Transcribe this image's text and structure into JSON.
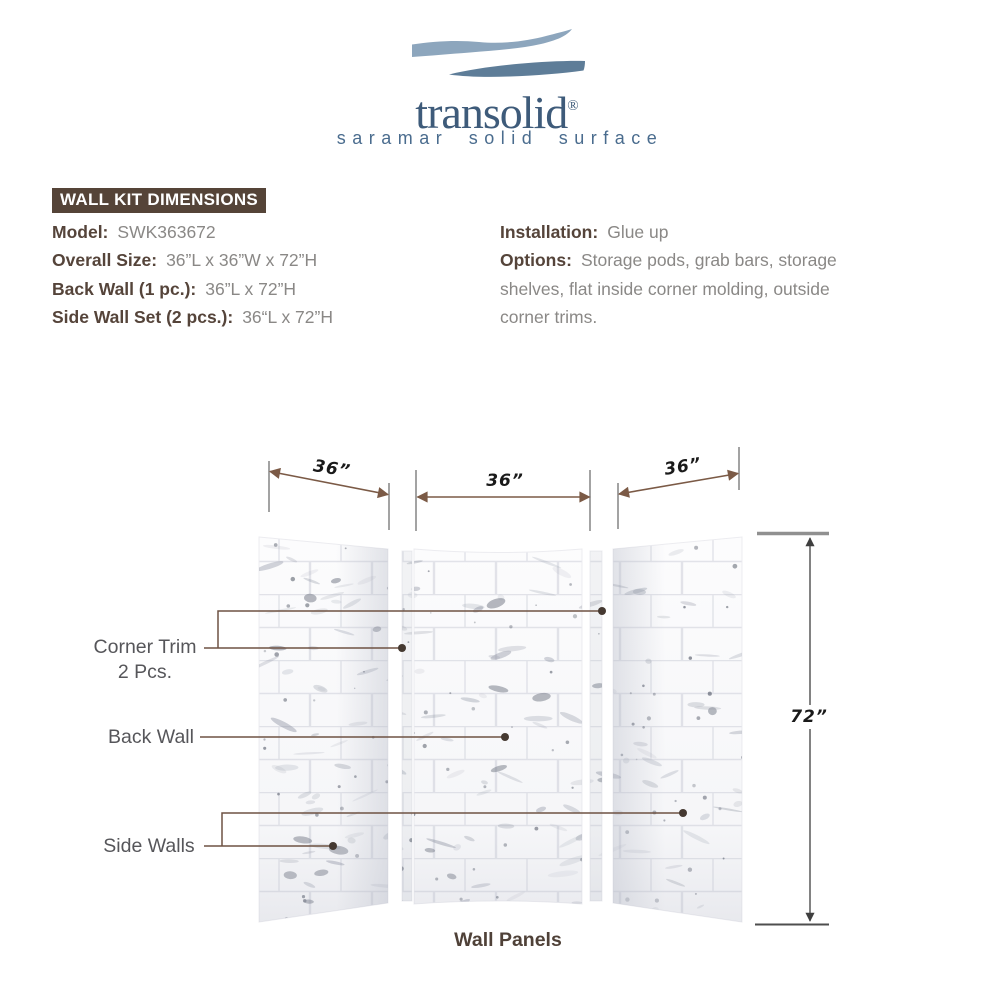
{
  "logo": {
    "brand": "transolid",
    "registered": "®",
    "tagline": "saramar solid surface"
  },
  "section": {
    "header": "WALL KIT DIMENSIONS"
  },
  "specs": {
    "left": [
      {
        "label": "Model:",
        "value": "SWK363672"
      },
      {
        "label": "Overall Size:",
        "value": "36”L x 36”W x 72”H"
      },
      {
        "label": "Back Wall (1 pc.):",
        "value": "36”L x 72”H"
      },
      {
        "label": "Side Wall Set (2 pcs.):",
        "value": "36“L x 72”H"
      }
    ],
    "right": [
      {
        "label": "Installation:",
        "value": "Glue up"
      },
      {
        "label": "Options:",
        "value": "Storage pods, grab bars, storage shelves, flat inside corner molding, outside corner trims."
      }
    ]
  },
  "diagram": {
    "dim_left_width": "36”",
    "dim_back_width": "36”",
    "dim_right_width": "36”",
    "dim_height": "72”",
    "labels": {
      "corner_trim_line1": "Corner Trim",
      "corner_trim_line2": "2 Pcs.",
      "back_wall": "Back Wall",
      "side_walls": "Side Walls"
    },
    "caption": "Wall Panels"
  },
  "colors": {
    "header_bar_brown": "#554438",
    "spec_label_brown": "#55443a",
    "spec_value_gray": "#8a8886",
    "leader_brown": "#6e5243",
    "dimension_brown": "#7b5a46",
    "logo_text_blue": "#3e5b7a",
    "wave_light_blue": "#8da6bd",
    "wave_dark_blue": "#5e7d98",
    "caption_brown": "#4f4138"
  }
}
